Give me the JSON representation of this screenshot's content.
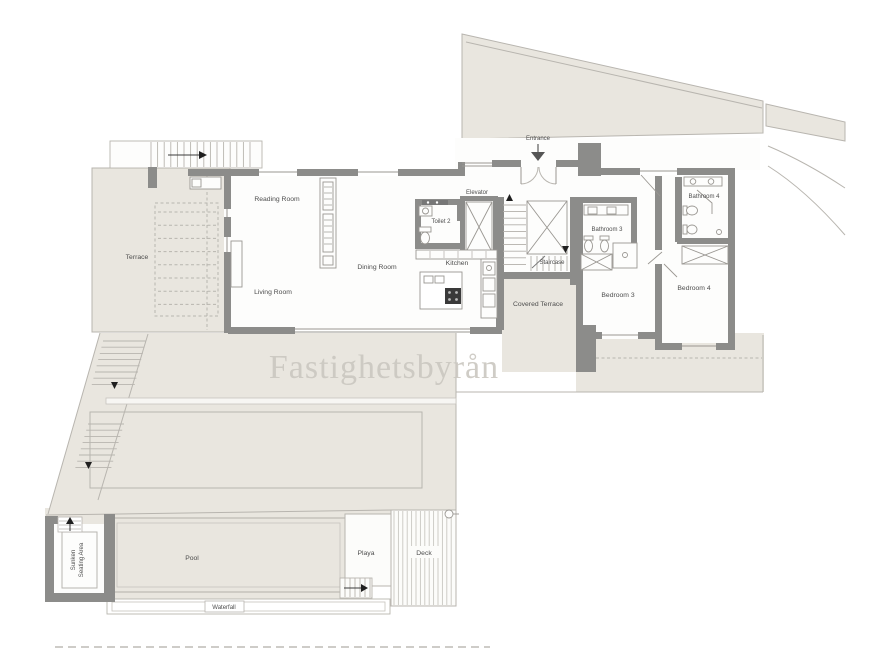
{
  "watermark": {
    "text": "Fastighetsbyrån"
  },
  "rooms": {
    "entrance": "Entrance",
    "terrace": "Terrace",
    "reading_room": "Reading Room",
    "living_room": "Living Room",
    "dining_room": "Dining Room",
    "kitchen": "Kitchen",
    "toilet_2": "Toilet 2",
    "elevator": "Elevator",
    "staircase": "Staircase",
    "covered_terrace": "Covered Terrace",
    "bathroom_3": "Bathroom 3",
    "bedroom_3": "Bedroom 3",
    "bathroom_4": "Bathroom 4",
    "bedroom_4": "Bedroom 4"
  },
  "outdoor": {
    "pool": "Pool",
    "playa": "Playa",
    "deck": "Deck",
    "waterfall": "Waterfall",
    "sunken_seating_line1": "Sunken",
    "sunken_seating_line2": "Seating Area"
  },
  "colors": {
    "paper": "#ffffff",
    "ground_beige": "#e9e6df",
    "wall_gray": "#8c8c8a",
    "line_gray": "#b8b5af",
    "label_gray": "#4d4d4d",
    "watermark_gray": "#cac7c0"
  }
}
